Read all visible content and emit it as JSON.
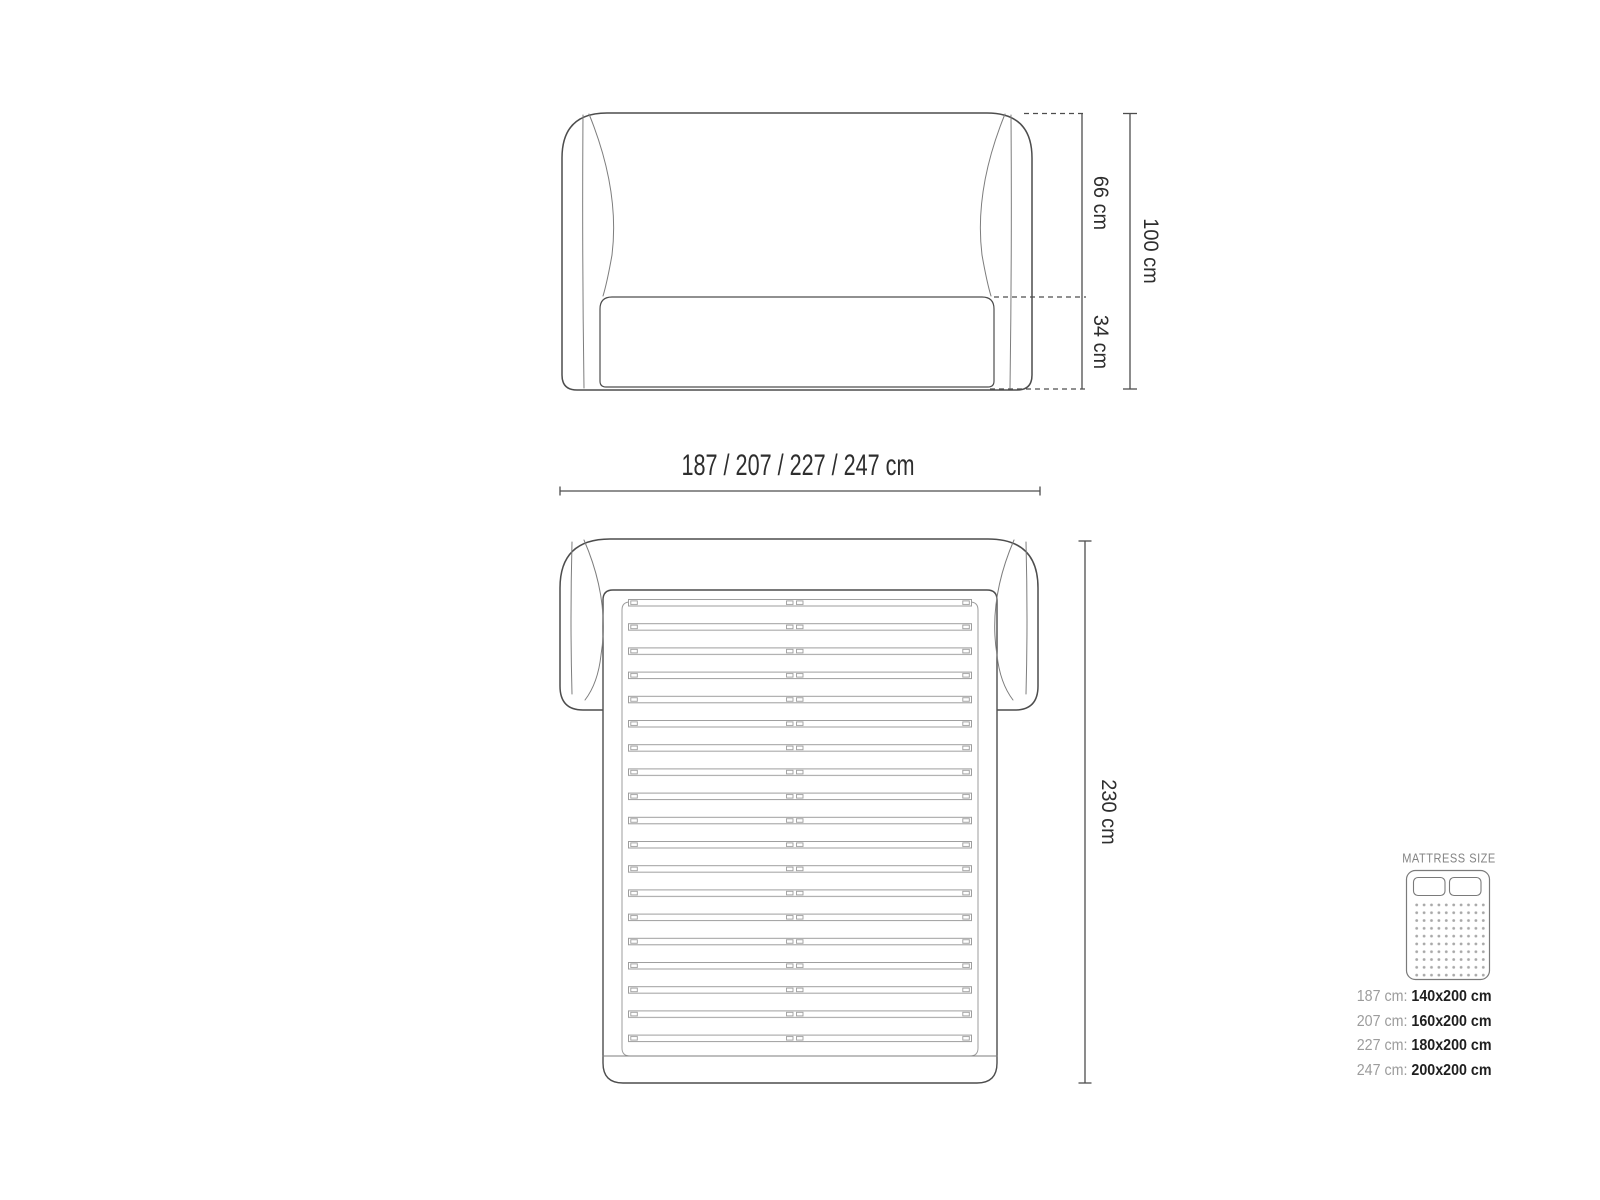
{
  "diagram": {
    "title": "bed dimensions technical drawing",
    "front_view": {
      "dim_headboard_height": "66 cm",
      "dim_base_height": "34 cm",
      "dim_total_height": "100 cm"
    },
    "width_dimension": "187 / 207 / 227 / 247 cm",
    "top_view": {
      "dim_depth": "230 cm"
    },
    "legend": {
      "title": "MATTRESS SIZE",
      "icon": "mattress-icon",
      "rows": [
        {
          "frame": "187 cm:",
          "mattress": "140x200 cm"
        },
        {
          "frame": "207 cm:",
          "mattress": "160x200 cm"
        },
        {
          "frame": "227 cm:",
          "mattress": "180x200 cm"
        },
        {
          "frame": "247 cm:",
          "mattress": "200x200 cm"
        }
      ]
    },
    "colors": {
      "outline": "#4d4d4d",
      "detail_line": "#7d7d7d",
      "slat_line": "#9e9e9e",
      "dimension_line": "#4d4d4d",
      "text": "#2e2e2e",
      "muted_text": "#9c9c9c",
      "background": "#ffffff"
    }
  }
}
